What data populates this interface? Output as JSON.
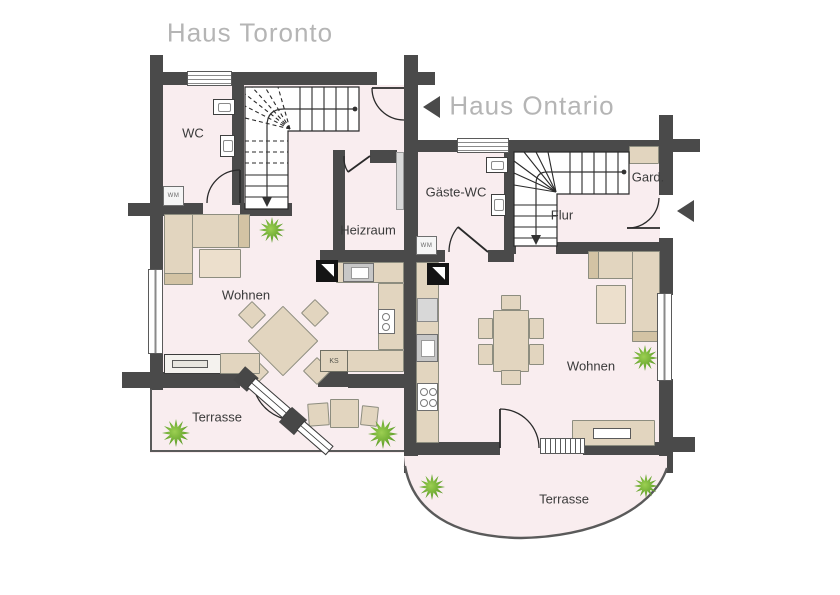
{
  "titles": {
    "toronto": "Haus Toronto",
    "ontario": "Haus Ontario"
  },
  "rooms": {
    "toronto": {
      "wc": "WC",
      "wohnen": "Wohnen",
      "heizraum": "Heizraum",
      "terrasse": "Terrasse"
    },
    "ontario": {
      "gaeste_wc": "Gäste-WC",
      "flur": "Flur",
      "gard": "Gard.",
      "wohnen": "Wohnen",
      "terrasse": "Terrasse"
    }
  },
  "appliances": {
    "wm": "WM",
    "ks": "KS"
  },
  "colors": {
    "wall": "#4a4a4a",
    "floor": "#f9edef",
    "furniture": "#e2d5bf",
    "plant": "#64a32c",
    "title_text": "#b5b5b5",
    "label_text": "#3a3a3a"
  }
}
